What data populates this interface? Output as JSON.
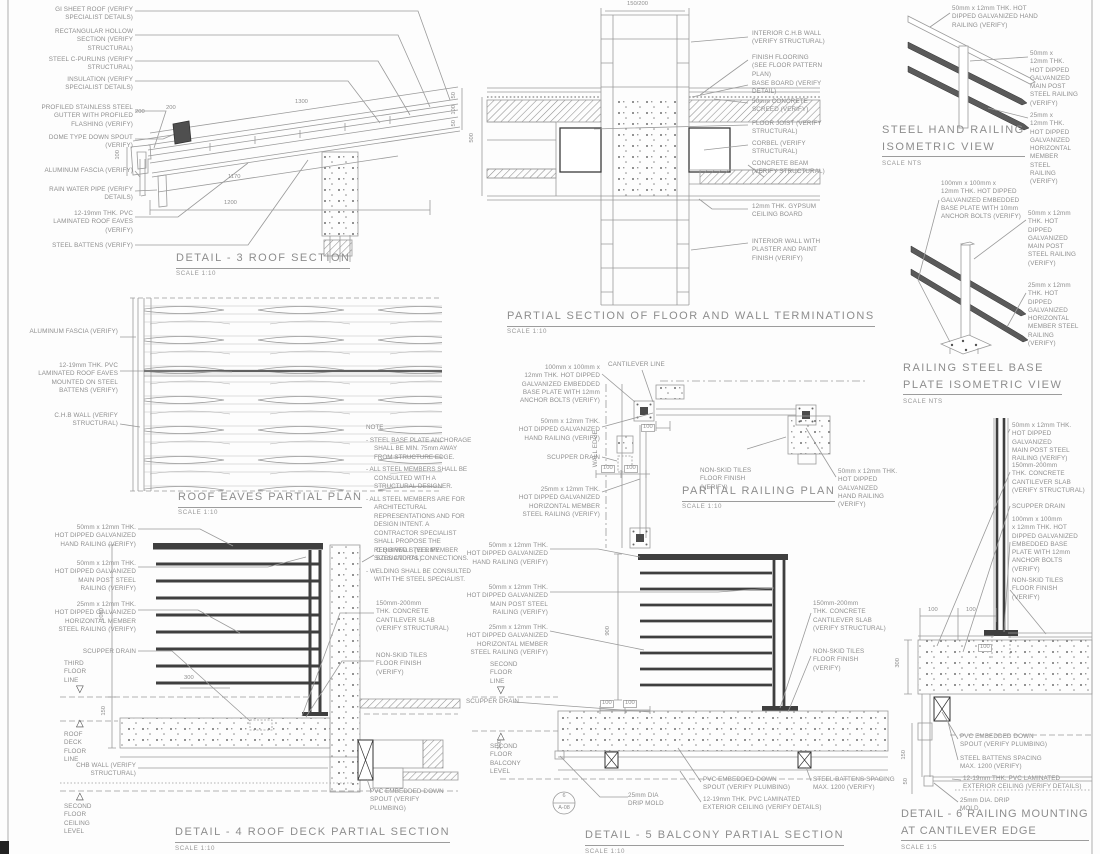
{
  "icons": {
    "level_down": "▽",
    "level_up": "△"
  },
  "d3": {
    "title": "DETAIL - 3 ROOF SECTION",
    "scale": "SCALE 1:10",
    "callouts": [
      "GI SHEET ROOF (VERIFY\nSPECIALIST DETAILS)",
      "RECTANGULAR HOLLOW\nSECTION (VERIFY\nSTRUCTURAL)",
      "STEEL C-PURLINS (VERIFY\nSTRUCTURAL)",
      "INSULATION (VERIFY\nSPECIALIST DETAILS)",
      "PROFILED STAINLESS STEEL\nGUTTER WITH PROFILED\nFLASHING (VERIFY)",
      "DOME TYPE DOWN SPOUT\n(VERIFY)",
      "ALUMINUM FASCIA (VERIFY)",
      "RAIN WATER PIPE (VERIFY\nDETAILS)",
      "12-19mm THK. PVC\nLAMINATED ROOF EAVES\n(VERIFY)",
      "STEEL BATTENS (VERIFY)"
    ],
    "dims": [
      "200",
      "200",
      "1300",
      "1170",
      "1200",
      "100"
    ]
  },
  "dfw": {
    "title": "PARTIAL SECTION OF FLOOR AND WALL TERMINATIONS",
    "scale": "SCALE 1:10",
    "callouts": [
      "INTERIOR C.H.B WALL\n(VERIFY STRUCTURAL)",
      "FINISH FLOORING\n(SEE FLOOR PATTERN\nPLAN)",
      "BASE BOARD (VERIFY\nDETAIL)",
      "50mm CONCRETE\nSCREED (VERIFY)",
      "FLOOR JOIST (VERIFY\nSTRUCTURAL)",
      "CORBEL (VERIFY\nSTRUCTURAL)",
      "CONCRETE BEAM\n(VERIFY STRUCTURAL)",
      "12mm THK. GYPSUM\nCEILING BOARD",
      "INTERIOR WALL WITH\nPLASTER AND PAINT\nFINISH (VERIFY)"
    ],
    "dims": [
      "150/200",
      "500",
      "50",
      "100",
      "50"
    ]
  },
  "iso1": {
    "title": "STEEL HAND RAILING\nISOMETRIC VIEW",
    "scale": "SCALE NTS",
    "callouts": [
      "50mm x 12mm THK. HOT\nDIPPED GALVANIZED HAND\nRAILING (VERIFY)",
      "50mm x\n12mm THK.\nHOT DIPPED\nGALVANIZED\nMAIN POST\nSTEEL RAILING\n(VERIFY)",
      "25mm x\n12mm THK.\nHOT DIPPED\nGALVANIZED\nHORIZONTAL\nMEMBER\nSTEEL\nRAILING\n(VERIFY)"
    ]
  },
  "iso2": {
    "title": "RAILING STEEL BASE\nPLATE ISOMETRIC VIEW",
    "scale": "SCALE NTS",
    "callouts": [
      "100mm x 100mm x\n12mm THK. HOT DIPPED\nGALVANIZED EMBEDDED\nBASE PLATE WITH 10mm\nANCHOR BOLTS (VERIFY)",
      "50mm x 12mm\nTHK. HOT\nDIPPED\nGALVANIZED\nMAIN POST\nSTEEL RAILING\n(VERIFY)",
      "25mm x 12mm\nTHK. HOT\nDIPPED\nGALVANIZED\nHORIZONTAL\nMEMBER STEEL\nRAILING\n(VERIFY)"
    ]
  },
  "eaves": {
    "title": "ROOF EAVES PARTIAL PLAN",
    "scale": "SCALE 1:10",
    "callouts": [
      "ALUMINUM FASCIA (VERIFY)",
      "12-19mm THK. PVC\nLAMINATED ROOF EAVES\nMOUNTED ON STEEL\nBATTENS (VERIFY)",
      "C.H.B WALL (VERIFY\nSTRUCTURAL)"
    ]
  },
  "note": {
    "title": "NOTE",
    "items": [
      "- STEEL BASE PLATE ANCHORAGE SHALL BE MIN. 75mm AWAY FROM STRUCTURE EDGE.",
      "- ALL STEEL MEMBERS SHALL BE CONSULTED WITH A STRUCTURAL DESIGNER.",
      "- ALL STEEL MEMBERS ARE FOR ARCHITECTURAL REPRESENTATIONS AND FOR DESIGN INTENT. A CONTRACTOR SPECIALIST SHALL PROPOSE THE REQUIRED STEEL MEMBER SIZES AND ITS CONNECTIONS.",
      "- WELDING SHALL BE CONSULTED WITH THE STEEL SPECIALIST."
    ]
  },
  "plan": {
    "title": "PARTIAL RAILING PLAN",
    "scale": "SCALE 1:10",
    "cantilever": "CANTILEVER LINE",
    "wall_edge": "WALL EDGE",
    "callouts": [
      "100mm x 100mm x\n12mm THK. HOT DIPPED\nGALVANIZED EMBEDDED\nBASE PLATE WITH 12mm\nANCHOR BOLTS (VERIFY)",
      "50mm x 12mm THK.\nHOT DIPPED GALVANIZED\nHAND RAILING (VERIFY)",
      "SCUPPER DRAIN",
      "25mm x 12mm THK.\nHOT DIPPED GALVANIZED\nHORIZONTAL MEMBER\nSTEEL RAILING (VERIFY)",
      "NON-SKID TILES\nFLOOR FINISH\n(VERIFY)",
      "50mm x 12mm THK.\nHOT DIPPED GALVANIZED\nHAND RAILING (VERIFY)"
    ],
    "dims": [
      "100",
      "100",
      "100"
    ]
  },
  "d4": {
    "title": "DETAIL - 4 ROOF DECK PARTIAL SECTION",
    "scale": "SCALE 1:10",
    "callouts": [
      "50mm x 12mm THK.\nHOT DIPPED GALVANIZED\nHAND RAILING (VERIFY)",
      "50mm x 12mm THK.\nHOT DIPPED GALVANIZED\nMAIN POST STEEL\nRAILING (VERIFY)",
      "25mm x 12mm THK.\nHOT DIPPED GALVANIZED\nHORIZONTAL MEMBER\nSTEEL RAILING (VERIFY)",
      "SCUPPER DRAIN",
      "CHB WALL (VERIFY\nSTRUCTURAL)",
      "C.H.B WALL (VERIFY\nSTRUCTURAL)",
      "150mm-200mm\nTHK. CONCRETE\nCANTILEVER SLAB\n(VERIFY STRUCTURAL)",
      "NON-SKID TILES\nFLOOR FINISH\n(VERIFY)",
      "PVC EMBEDDED DOWN\nSPOUT (VERIFY\nPLUMBING)"
    ],
    "levels": [
      "THIRD\nFLOOR\nLINE",
      "ROOF\nDECK\nFLOOR\nLINE",
      "SECOND\nFLOOR\nCEILING\nLEVEL"
    ],
    "dims": [
      "1050",
      "150",
      "300"
    ]
  },
  "d5": {
    "title": "DETAIL - 5 BALCONY PARTIAL SECTION",
    "scale": "SCALE 1:10",
    "callouts": [
      "50mm x 12mm THK.\nHOT DIPPED GALVANIZED\nHAND RAILING (VERIFY)",
      "50mm x 12mm THK.\nHOT DIPPED GALVANIZED\nMAIN POST STEEL\nRAILING (VERIFY)",
      "25mm x 12mm THK.\nHOT DIPPED GALVANIZED\nHORIZONTAL MEMBER\nSTEEL RAILING (VERIFY)",
      "SCUPPER DRAIN",
      "150mm-200mm\nTHK. CONCRETE\nCANTILEVER SLAB\n(VERIFY STRUCTURAL)",
      "NON-SKID TILES\nFLOOR FINISH\n(VERIFY)",
      "25mm DIA\nDRIP MOLD",
      "PVC EMBEDDED DOWN\nSPOUT (VERIFY PLUMBING)",
      "12-19mm THK. PVC LAMINATED\nEXTERIOR CEILING (VERIFY DETAILS)",
      "STEEL BATTENS SPACING\nMAX. 1200 (VERIFY)"
    ],
    "levels": [
      "SECOND\nFLOOR\nLINE",
      "SECOND\nFLOOR\nBALCONY\nLEVEL"
    ],
    "dims": [
      "900",
      "100",
      "100",
      "300"
    ],
    "ref": {
      "top": "6",
      "bottom": "A-08"
    }
  },
  "d6": {
    "title": "DETAIL - 6 RAILING MOUNTING\nAT CANTILEVER EDGE",
    "scale": "SCALE 1:5",
    "callouts": [
      "50mm x 12mm THK.\nHOT DIPPED GALVANIZED\nMAIN POST STEEL\nRAILING (VERIFY)",
      "150mm-200mm\nTHK. CONCRETE\nCANTILEVER SLAB\n(VERIFY STRUCTURAL)",
      "SCUPPER DRAIN",
      "100mm x 100mm\nx 12mm THK. HOT\nDIPPED GALVANIZED\nEMBEDDED BASE\nPLATE WITH 12mm\nANCHOR BOLTS\n(VERIFY)",
      "NON-SKID TILES\nFLOOR FINISH\n(VERIFY)",
      "PVC EMBEDDED DOWN\nSPOUT (VERIFY PLUMBING)",
      "STEEL BATTENS SPACING\nMAX. 1200 (VERIFY)",
      "12-19mm THK. PVC LAMINATED\nEXTERIOR CEILING (VERIFY DETAILS)",
      "25mm DIA. DRIP\nMOLD"
    ],
    "dims": [
      "100",
      "100",
      "100",
      "300",
      "150",
      "50"
    ]
  }
}
